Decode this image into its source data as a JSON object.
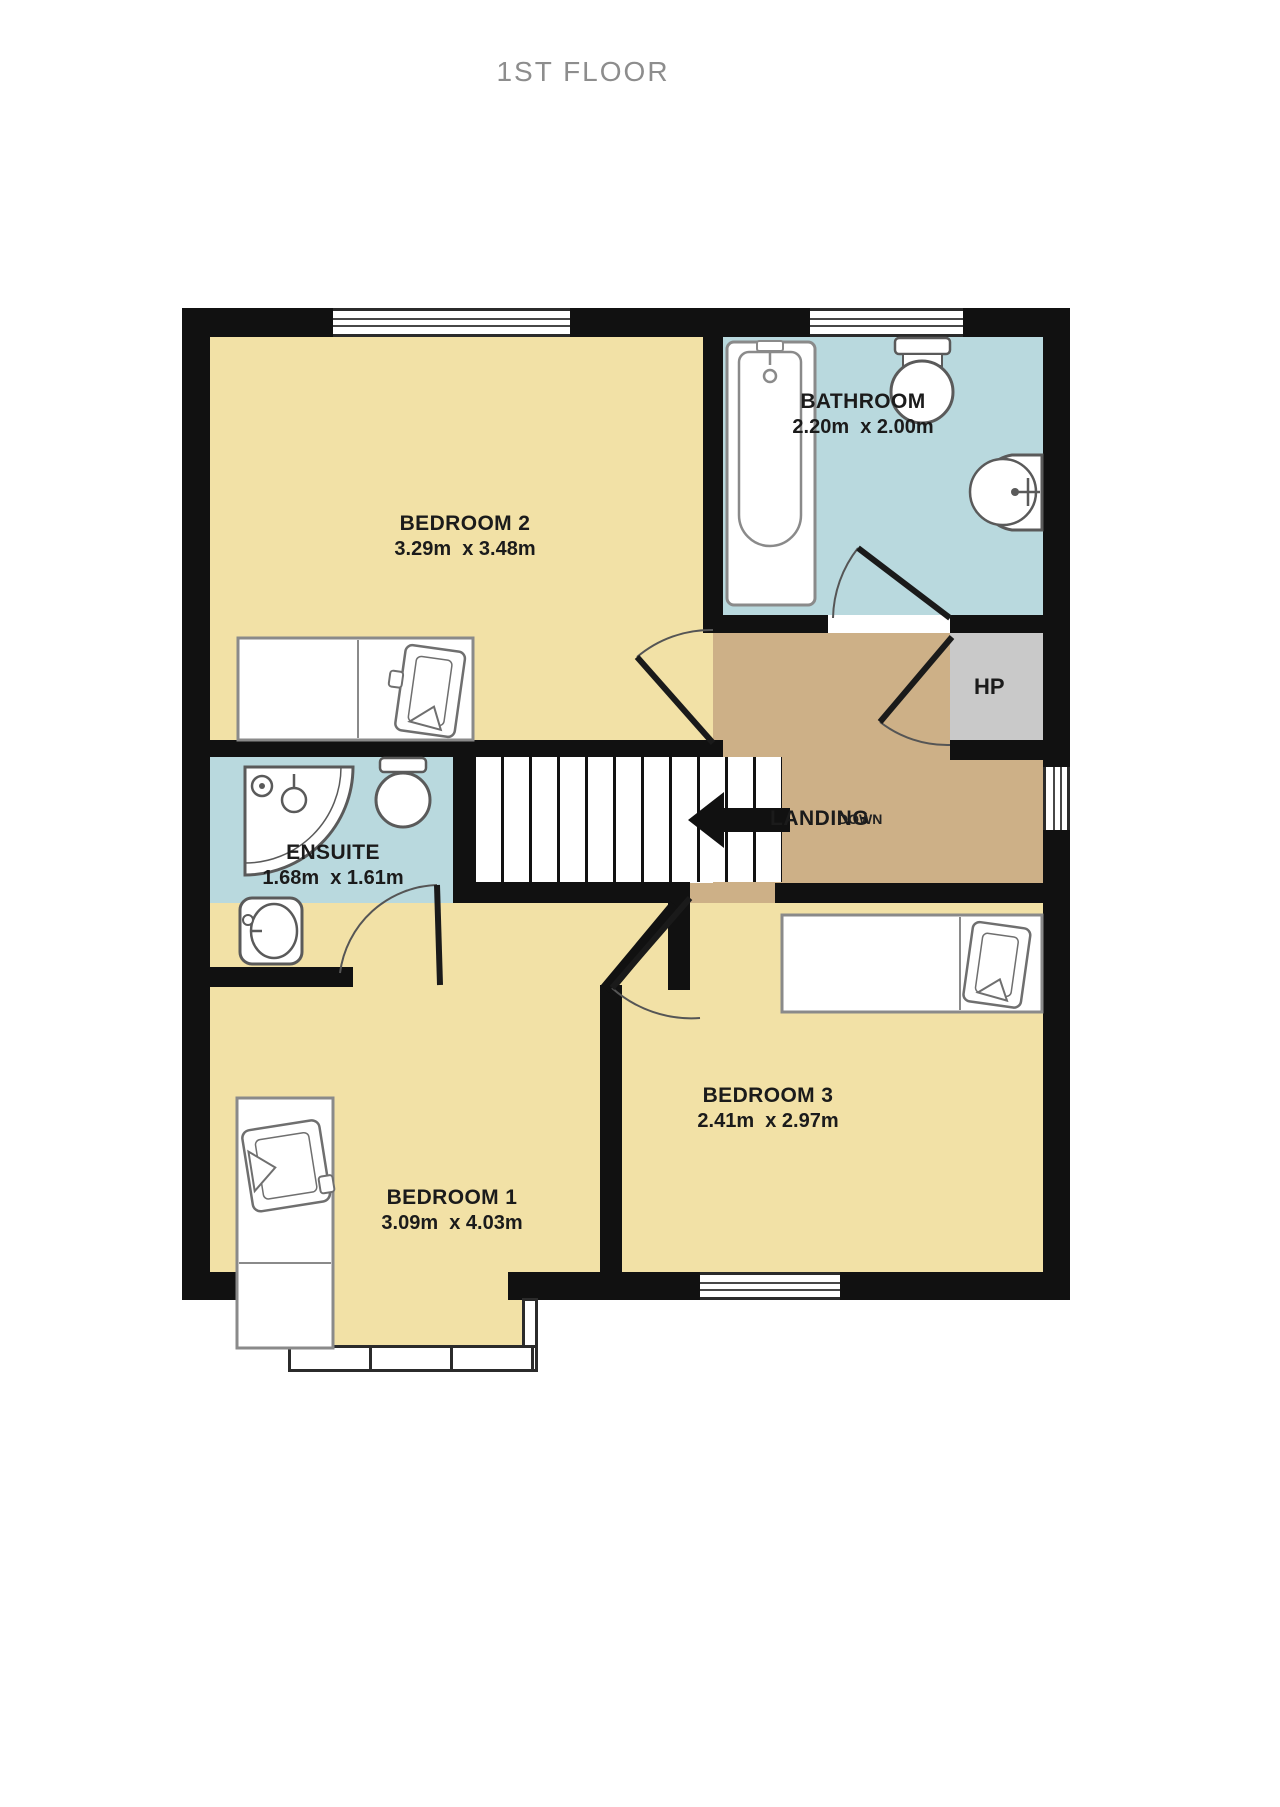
{
  "title": "1ST FLOOR",
  "rooms": {
    "bedroom2": {
      "name": "BEDROOM 2",
      "dims": "3.29m  x 3.48m"
    },
    "bathroom": {
      "name": "BATHROOM",
      "dims": "2.20m  x 2.00m"
    },
    "ensuite": {
      "name": "ENSUITE",
      "dims": "1.68m  x 1.61m"
    },
    "bedroom1": {
      "name": "BEDROOM 1",
      "dims": "3.09m  x 4.03m"
    },
    "bedroom3": {
      "name": "BEDROOM 3",
      "dims": "2.41m  x 2.97m"
    },
    "hot_press": {
      "name": "HP"
    },
    "landing": {
      "name": "LANDING",
      "stairs_label": "DOWN"
    }
  },
  "fixtures": {
    "bathroom": [
      "bathtub",
      "toilet",
      "wash-basin"
    ],
    "ensuite": [
      "corner-shower",
      "toilet",
      "wash-basin"
    ],
    "bedroom1": [
      "bed"
    ],
    "bedroom2": [
      "bed"
    ],
    "bedroom3": [
      "bed"
    ]
  },
  "colors": {
    "room_yellow": "#F2E1A6",
    "room_blue": "#B9D9DE",
    "landing_tan": "#CDB087",
    "hp_gray": "#C9C9C9",
    "wall_black": "#111111",
    "label_dark": "#1B1B1B",
    "title_gray": "#8D8D8D"
  }
}
